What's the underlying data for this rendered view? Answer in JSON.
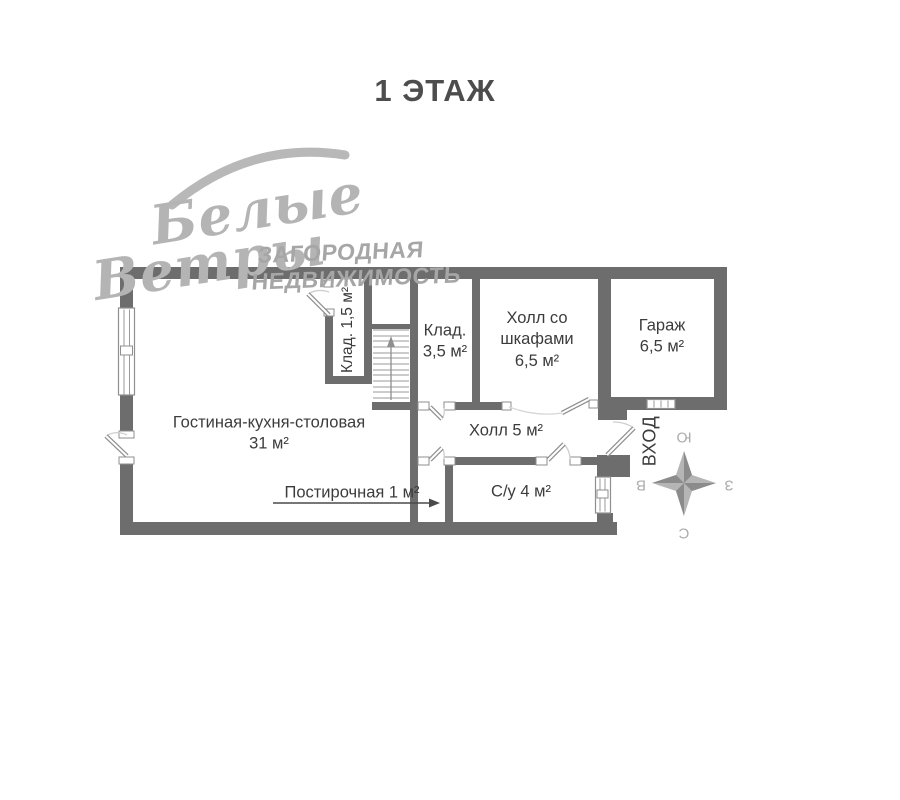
{
  "title": "1 ЭТАЖ",
  "watermark": {
    "script_line1": "Белые",
    "script_line2": "Ветры",
    "tagline_line1": "ЗАГОРОДНАЯ",
    "tagline_line2": "НЕДВИЖИМОСТЬ"
  },
  "plan": {
    "rooms": {
      "living": {
        "name": "Гостиная-кухня-столовая",
        "area": "31 м²"
      },
      "closet_small": {
        "label": "Клад. 1,5 м²"
      },
      "closet_large": {
        "name": "Клад.",
        "area": "3,5 м²"
      },
      "hall_wardrobes": {
        "line1": "Холл со",
        "line2": "шкафами",
        "area": "6,5 м²"
      },
      "garage": {
        "name": "Гараж",
        "area": "6,5 м²"
      },
      "hall": {
        "label": "Холл 5 м²"
      },
      "laundry": {
        "label": "Постирочная 1 м²"
      },
      "bathroom": {
        "label": "С/у 4 м²"
      }
    },
    "entrance_label": "ВХОД",
    "compass": {
      "top": "Ю",
      "left": "В",
      "right": "З",
      "bottom": "С"
    }
  },
  "colors": {
    "wall": "#6d6d6d",
    "text": "#3c3c3c",
    "watermark": "#b4b4b4",
    "compass": "#b5b5b5"
  }
}
